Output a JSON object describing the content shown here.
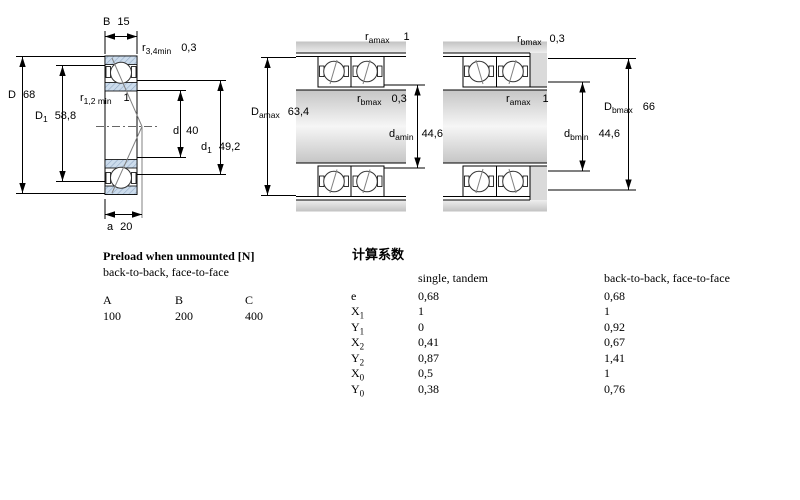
{
  "colors": {
    "bearing_fill": "#ccdcec",
    "bearing_hatch": "#93a9c4",
    "steel_dark": "#c2c2c2",
    "steel_light": "#f4f4f4",
    "line": "#000000"
  },
  "drawings": {
    "left": {
      "labels": {
        "B": {
          "sym": "B",
          "sub": "",
          "val": "15"
        },
        "r34": {
          "sym": "r",
          "sub": "3,4min",
          "val": "0,3"
        },
        "D": {
          "sym": "D",
          "sub": "",
          "val": "68"
        },
        "D1": {
          "sym": "D",
          "sub": "1",
          "val": "58,8"
        },
        "r12": {
          "sym": "r",
          "sub": "1,2 min",
          "val": "1"
        },
        "d": {
          "sym": "d",
          "sub": "",
          "val": "40"
        },
        "d1": {
          "sym": "d",
          "sub": "1",
          "val": "49,2"
        },
        "a": {
          "sym": "a",
          "sub": "",
          "val": "20"
        }
      }
    },
    "middle": {
      "labels": {
        "ramax": {
          "sym": "r",
          "sub": "amax",
          "val": "1"
        },
        "rbmax": {
          "sym": "r",
          "sub": "bmax",
          "val": "0,3"
        },
        "Damax": {
          "sym": "D",
          "sub": "amax",
          "val": "63,4"
        },
        "damin": {
          "sym": "d",
          "sub": "amin",
          "val": "44,6"
        }
      }
    },
    "right": {
      "labels": {
        "rbmax": {
          "sym": "r",
          "sub": "bmax",
          "val": "0,3"
        },
        "ramax": {
          "sym": "r",
          "sub": "amax",
          "val": "1"
        },
        "Dbmax": {
          "sym": "D",
          "sub": "bmax",
          "val": "66"
        },
        "dbmin": {
          "sym": "d",
          "sub": "bmin",
          "val": "44,6"
        }
      }
    }
  },
  "preload": {
    "title": "Preload when unmounted [N]",
    "subtitle": "back-to-back, face-to-face",
    "columns": [
      "A",
      "B",
      "C"
    ],
    "values": [
      "100",
      "200",
      "400"
    ]
  },
  "factors": {
    "title": "计算系数",
    "col1_header": "single, tandem",
    "col2_header": "back-to-back, face-to-face",
    "rows": [
      {
        "sym": "e",
        "sub": "",
        "single": "0,68",
        "paired": "0,68"
      },
      {
        "sym": "X",
        "sub": "1",
        "single": "1",
        "paired": "1"
      },
      {
        "sym": "Y",
        "sub": "1",
        "single": "0",
        "paired": "0,92"
      },
      {
        "sym": "X",
        "sub": "2",
        "single": "0,41",
        "paired": "0,67"
      },
      {
        "sym": "Y",
        "sub": "2",
        "single": "0,87",
        "paired": "1,41"
      },
      {
        "sym": "X",
        "sub": "0",
        "single": "0,5",
        "paired": "1"
      },
      {
        "sym": "Y",
        "sub": "0",
        "single": "0,38",
        "paired": "0,76"
      }
    ]
  }
}
